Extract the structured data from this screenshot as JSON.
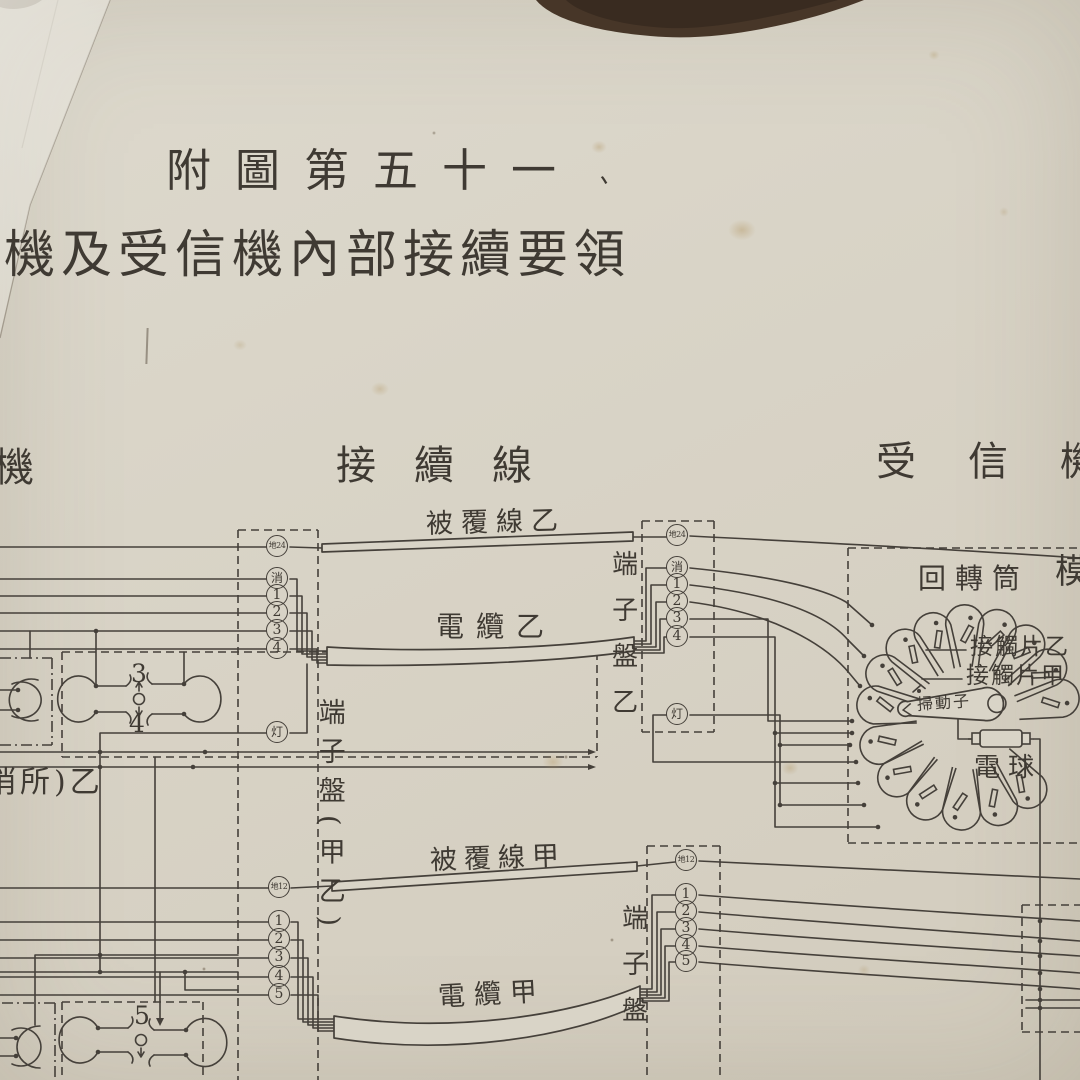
{
  "photo": {
    "background_color": "#473628",
    "paper_color": "#d9d4c7",
    "ink_color": "#45403a"
  },
  "title": {
    "figure_no": "附圖第五十一",
    "subject": "機及受信機內部接續要領",
    "tick_mark": "、"
  },
  "section_headers": {
    "left": "機",
    "center": "接續線",
    "right": "受信機"
  },
  "wire_labels": {
    "covered_wire_b": "被覆線乙",
    "cable_b": "電纜乙",
    "covered_wire_a": "被覆線甲",
    "cable_a": "電纜甲"
  },
  "terminal_boards": {
    "center": "端子盤(甲乙)",
    "right_b": "端子盤乙",
    "right_a": "端子盤"
  },
  "receiver_labels": {
    "rotating_drum": "回轉筒",
    "contact_piece_b": "接觸片乙",
    "contact_piece_a": "接觸片甲",
    "wiper": "掃動子",
    "bulb": "電球",
    "edge_char": "模"
  },
  "machine_labels": {
    "switch_upper": "3",
    "switch_lower": "4",
    "switch_bottom": "5",
    "post_note": "哨所)乙"
  },
  "terminals": {
    "top_left": [
      "地24",
      "消",
      "1",
      "2",
      "3",
      "4",
      "灯"
    ],
    "top_right": [
      "地24",
      "消",
      "1",
      "2",
      "3",
      "4",
      "灯"
    ],
    "bottom_left": [
      "地12",
      "1",
      "2",
      "3",
      "4",
      "5"
    ],
    "bottom_right": [
      "地12",
      "1",
      "2",
      "3",
      "4",
      "5"
    ]
  }
}
